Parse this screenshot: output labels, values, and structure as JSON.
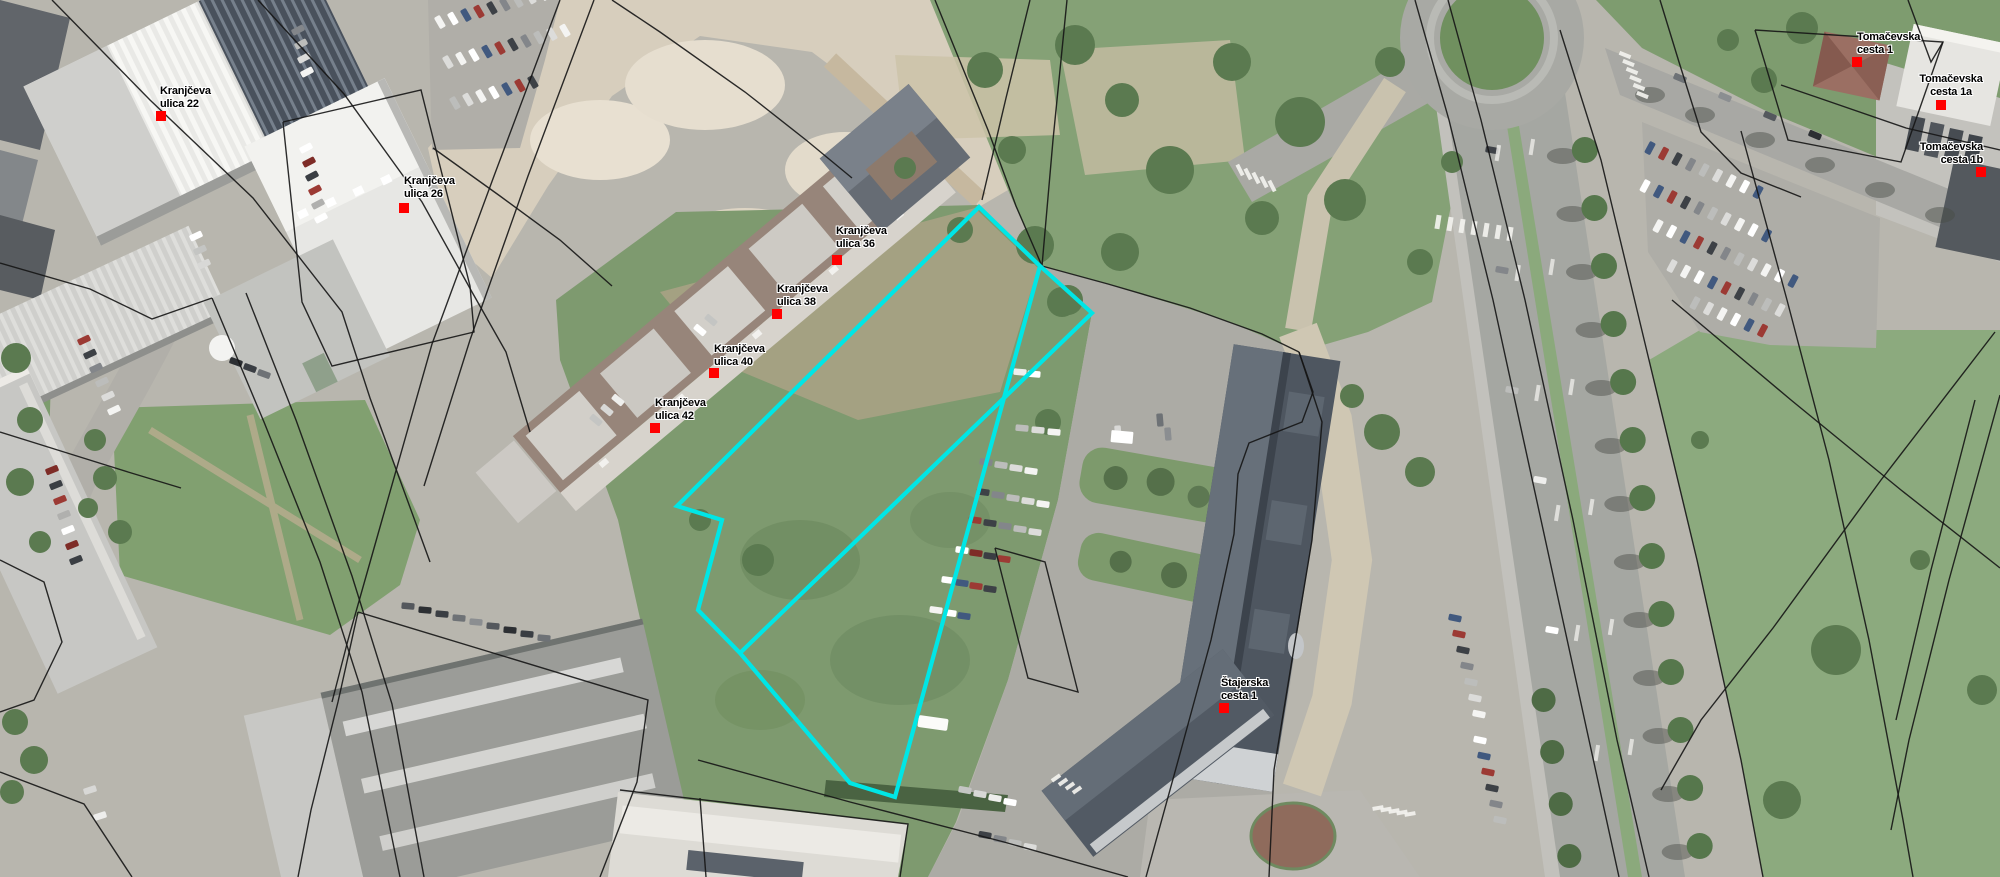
{
  "map": {
    "description": "Aerial orthophoto with cadastral parcel overlay and highlighted parcel",
    "width": 2000,
    "height": 877,
    "colors": {
      "parcel_highlight": "#00e6e6",
      "address_marker": "#ff0000",
      "cadastral_line": "#151515",
      "label_text": "#000000",
      "label_halo": "#ffffff"
    },
    "address_labels": [
      {
        "id": "kranjceva-ulica-22",
        "lines": [
          "Kranjčeva",
          "ulica 22"
        ],
        "align": "left",
        "text_x": 160,
        "text_y": 85,
        "marker_x": 156,
        "marker_y": 111
      },
      {
        "id": "kranjceva-ulica-26",
        "lines": [
          "Kranjčeva",
          "ulica 26"
        ],
        "align": "left",
        "text_x": 404,
        "text_y": 175,
        "marker_x": 399,
        "marker_y": 203
      },
      {
        "id": "kranjceva-ulica-36",
        "lines": [
          "Kranjčeva",
          "ulica 36"
        ],
        "align": "left",
        "text_x": 836,
        "text_y": 225,
        "marker_x": 832,
        "marker_y": 255
      },
      {
        "id": "kranjceva-ulica-38",
        "lines": [
          "Kranjčeva",
          "ulica 38"
        ],
        "align": "left",
        "text_x": 777,
        "text_y": 283,
        "marker_x": 772,
        "marker_y": 309
      },
      {
        "id": "kranjceva-ulica-40",
        "lines": [
          "Kranjčeva",
          "ulica 40"
        ],
        "align": "left",
        "text_x": 714,
        "text_y": 343,
        "marker_x": 709,
        "marker_y": 368
      },
      {
        "id": "kranjceva-ulica-42",
        "lines": [
          "Kranjčeva",
          "ulica 42"
        ],
        "align": "left",
        "text_x": 655,
        "text_y": 397,
        "marker_x": 650,
        "marker_y": 423
      },
      {
        "id": "stajerska-cesta-1",
        "lines": [
          "Štajerska",
          "cesta 1"
        ],
        "align": "left",
        "text_x": 1221,
        "text_y": 677,
        "marker_x": 1219,
        "marker_y": 703
      },
      {
        "id": "tomacevska-cesta-1",
        "lines": [
          "Tomačevska",
          "cesta 1"
        ],
        "align": "left",
        "text_x": 1857,
        "text_y": 31,
        "marker_x": 1852,
        "marker_y": 57
      },
      {
        "id": "tomacevska-cesta-1a",
        "lines": [
          "Tomačevska",
          "cesta 1a"
        ],
        "align": "center",
        "text_x": 1951,
        "text_y": 73,
        "marker_x": 1936,
        "marker_y": 100
      },
      {
        "id": "tomacevska-cesta-1b",
        "lines": [
          "Tomačevska",
          "cesta 1b"
        ],
        "align": "right",
        "text_x": 1983,
        "text_y": 141,
        "marker_x": 1976,
        "marker_y": 167
      }
    ],
    "highlighted_parcel": {
      "stroke_width": 4.2,
      "outline": [
        [
          979,
          207
        ],
        [
          677,
          506
        ],
        [
          722,
          520
        ],
        [
          698,
          610
        ],
        [
          740,
          653
        ],
        [
          850,
          783
        ],
        [
          895,
          797
        ],
        [
          1040,
          266
        ]
      ],
      "inner_edge": [
        [
          1040,
          266
        ],
        [
          1092,
          313
        ],
        [
          740,
          653
        ]
      ]
    },
    "cadastral_lines": [
      [
        [
          52,
          0
        ],
        [
          150,
          100
        ],
        [
          253,
          198
        ],
        [
          342,
          312
        ],
        [
          370,
          398
        ],
        [
          400,
          480
        ],
        [
          430,
          562
        ]
      ],
      [
        [
          212,
          298
        ],
        [
          264,
          422
        ],
        [
          320,
          562
        ],
        [
          362,
          692
        ],
        [
          400,
          877
        ]
      ],
      [
        [
          246,
          293
        ],
        [
          296,
          420
        ],
        [
          352,
          576
        ],
        [
          392,
          704
        ],
        [
          424,
          877
        ]
      ],
      [
        [
          258,
          0
        ],
        [
          344,
          94
        ],
        [
          422,
          202
        ],
        [
          472,
          292
        ],
        [
          506,
          352
        ],
        [
          530,
          432
        ]
      ],
      [
        [
          283,
          122
        ],
        [
          421,
          90
        ],
        [
          470,
          286
        ],
        [
          474,
          332
        ],
        [
          332,
          366
        ],
        [
          302,
          302
        ],
        [
          283,
          122
        ]
      ],
      [
        [
          0,
          263
        ],
        [
          90,
          289
        ],
        [
          152,
          319
        ],
        [
          212,
          298
        ]
      ],
      [
        [
          560,
          0
        ],
        [
          494,
          176
        ],
        [
          432,
          344
        ],
        [
          382,
          520
        ],
        [
          348,
          640
        ],
        [
          332,
          702
        ]
      ],
      [
        [
          594,
          0
        ],
        [
          528,
          176
        ],
        [
          470,
          340
        ],
        [
          424,
          486
        ]
      ],
      [
        [
          433,
          148
        ],
        [
          500,
          196
        ],
        [
          560,
          240
        ],
        [
          612,
          286
        ]
      ],
      [
        [
          612,
          0
        ],
        [
          660,
          32
        ],
        [
          745,
          92
        ],
        [
          806,
          140
        ],
        [
          852,
          178
        ]
      ],
      [
        [
          935,
          0
        ],
        [
          988,
          130
        ],
        [
          1016,
          206
        ],
        [
          1042,
          266
        ]
      ],
      [
        [
          1030,
          0
        ],
        [
          1006,
          98
        ],
        [
          982,
          200
        ]
      ],
      [
        [
          1067,
          0
        ],
        [
          1053,
          140
        ],
        [
          1042,
          266
        ]
      ],
      [
        [
          1042,
          266
        ],
        [
          1108,
          284
        ],
        [
          1190,
          308
        ],
        [
          1262,
          334
        ],
        [
          1299,
          352
        ]
      ],
      [
        [
          1299,
          352
        ],
        [
          1313,
          392
        ],
        [
          1302,
          422
        ],
        [
          1249,
          443
        ],
        [
          1238,
          474
        ],
        [
          1234,
          534
        ],
        [
          1211,
          640
        ],
        [
          1181,
          750
        ],
        [
          1146,
          877
        ]
      ],
      [
        [
          1299,
          352
        ],
        [
          1322,
          422
        ],
        [
          1312,
          540
        ],
        [
          1292,
          660
        ],
        [
          1274,
          770
        ],
        [
          1269,
          877
        ]
      ],
      [
        [
          1415,
          0
        ],
        [
          1449,
          120
        ],
        [
          1493,
          300
        ],
        [
          1541,
          520
        ],
        [
          1589,
          740
        ],
        [
          1619,
          877
        ]
      ],
      [
        [
          1448,
          0
        ],
        [
          1481,
          120
        ],
        [
          1525,
          300
        ],
        [
          1573,
          520
        ],
        [
          1617,
          740
        ],
        [
          1649,
          877
        ]
      ],
      [
        [
          1560,
          30
        ],
        [
          1601,
          160
        ],
        [
          1649,
          360
        ],
        [
          1697,
          560
        ],
        [
          1741,
          760
        ],
        [
          1763,
          877
        ]
      ],
      [
        [
          1660,
          0
        ],
        [
          1679,
          62
        ],
        [
          1701,
          132
        ],
        [
          1741,
          173
        ],
        [
          1801,
          197
        ]
      ],
      [
        [
          1741,
          131
        ],
        [
          1787,
          300
        ],
        [
          1829,
          460
        ],
        [
          1869,
          640
        ],
        [
          1903,
          820
        ],
        [
          1913,
          877
        ]
      ],
      [
        [
          1672,
          300
        ],
        [
          1791,
          400
        ],
        [
          1901,
          490
        ],
        [
          2000,
          568
        ]
      ],
      [
        [
          1995,
          332
        ],
        [
          1881,
          480
        ],
        [
          1773,
          628
        ],
        [
          1701,
          720
        ],
        [
          1661,
          790
        ]
      ],
      [
        [
          2000,
          150
        ],
        [
          1906,
          128
        ],
        [
          1819,
          98
        ],
        [
          1781,
          85
        ]
      ],
      [
        [
          1755,
          30
        ],
        [
          1788,
          140
        ],
        [
          1901,
          162
        ],
        [
          1943,
          42
        ],
        [
          1755,
          30
        ]
      ],
      [
        [
          1908,
          0
        ],
        [
          1931,
          62
        ],
        [
          1943,
          42
        ]
      ],
      [
        [
          2000,
          395
        ],
        [
          1949,
          580
        ],
        [
          1909,
          740
        ],
        [
          1891,
          830
        ]
      ],
      [
        [
          1975,
          400
        ],
        [
          1931,
          570
        ],
        [
          1896,
          720
        ]
      ],
      [
        [
          358,
          612
        ],
        [
          648,
          700
        ],
        [
          637,
          782
        ],
        [
          600,
          877
        ]
      ],
      [
        [
          358,
          612
        ],
        [
          338,
          702
        ],
        [
          311,
          810
        ],
        [
          298,
          877
        ]
      ],
      [
        [
          0,
          432
        ],
        [
          64,
          452
        ],
        [
          128,
          472
        ],
        [
          181,
          488
        ]
      ],
      [
        [
          700,
          798
        ],
        [
          706,
          877
        ]
      ],
      [
        [
          698,
          760
        ],
        [
          850,
          802
        ],
        [
          1004,
          842
        ],
        [
          1128,
          877
        ]
      ],
      [
        [
          0,
          560
        ],
        [
          44,
          582
        ],
        [
          62,
          642
        ],
        [
          34,
          700
        ],
        [
          0,
          712
        ]
      ],
      [
        [
          0,
          772
        ],
        [
          84,
          804
        ],
        [
          132,
          877
        ]
      ],
      [
        [
          995,
          548
        ],
        [
          1045,
          562
        ],
        [
          1078,
          692
        ],
        [
          1028,
          678
        ],
        [
          995,
          548
        ]
      ],
      [
        [
          620,
          790
        ],
        [
          908,
          824
        ],
        [
          900,
          877
        ]
      ]
    ]
  }
}
